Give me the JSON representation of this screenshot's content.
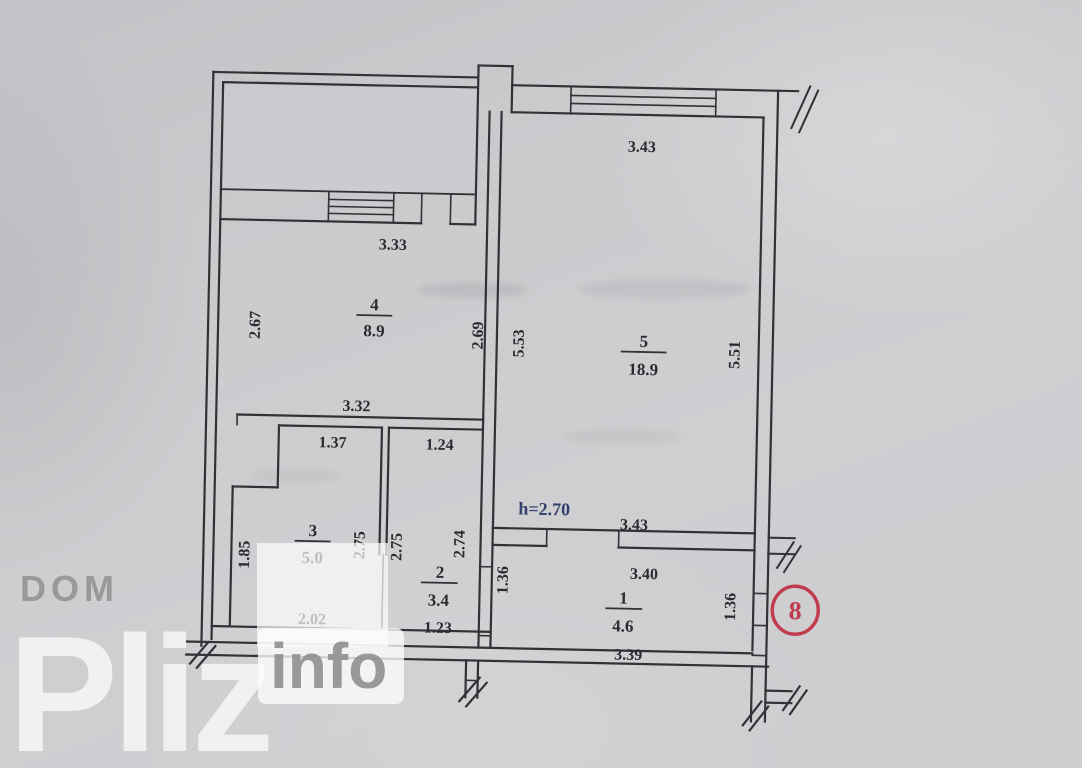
{
  "watermark": {
    "dom": "DOM",
    "pliz": "Pliz",
    "info": "info"
  },
  "plan": {
    "height_note": "h=2.70",
    "entrance_number": "8",
    "rooms": {
      "r1": {
        "number": "1",
        "area": "4.6",
        "dims": {
          "top": "3.40",
          "bottom": "3.39",
          "left": "1.36",
          "right": "1.36"
        }
      },
      "r2": {
        "number": "2",
        "area": "3.4",
        "dims": {
          "top": "1.24",
          "bottom": "1.23",
          "left": "2.75",
          "right": "2.74"
        }
      },
      "r3": {
        "number": "3",
        "area": "5.0",
        "dims": {
          "top": "1.37",
          "bottom": "2.02",
          "left": "1.85",
          "right": "2.75"
        }
      },
      "r4": {
        "number": "4",
        "area": "8.9",
        "dims": {
          "top": "3.33",
          "bottom": "3.32",
          "left": "2.67",
          "right": "2.69"
        }
      },
      "r5": {
        "number": "5",
        "area": "18.9",
        "dims": {
          "top": "3.43",
          "bottom": "3.43",
          "left": "5.53",
          "right": "5.51"
        }
      }
    },
    "colors": {
      "line": "#323236",
      "paper": "#c9c9cc",
      "height_note": "#32406e",
      "stamp_red": "#c13b4e",
      "watermark_gray": "#96989a",
      "watermark_white": "#f7f8f8"
    }
  }
}
